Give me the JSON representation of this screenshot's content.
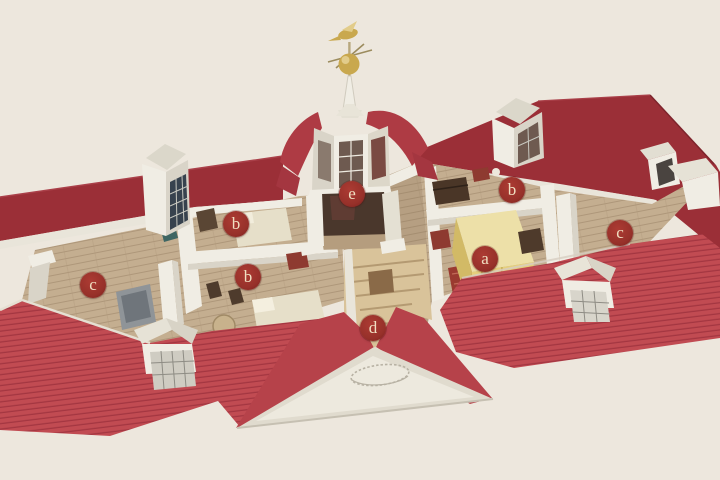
{
  "figure": {
    "type": "architectural-cutaway-illustration",
    "subject": "Bird's-eye cutaway of the third floor of a red-roofed mansion with central cupola, dormers and lettered room markers",
    "background_color": "#EDE7DD",
    "colors": {
      "roof_front": "#C14B52",
      "roof_front_line": "#A33641",
      "roof_back": "#9B2F37",
      "roof_back_edge": "#7E242C",
      "roof_smooth": "#B6424A",
      "cupola_roof": "#AE3B44",
      "cornice": "#E9E5DA",
      "wall": "#F0EDE4",
      "wall_shade": "#D9D4C8",
      "floor": "#C4AE90",
      "floor_line": "#AE977A",
      "floor_center_tint": "#8A7356",
      "interior_dark": "#4A372C",
      "window_dark": "#37424E",
      "window_red": "#6E5A50",
      "gold": "#C9A84E",
      "gold_light": "#E2CC8A",
      "stairs": "#D9C39A",
      "stair_line": "#B49A72",
      "bed_yellow": "#E5CF7C",
      "bed_cream": "#E6DFC9",
      "rug_red": "#9A3A30",
      "chest_red": "#8E3A30",
      "wood_dark": "#4A3627",
      "pediment": "#E0DBCE",
      "pediment_face": "#EDE9DE",
      "marker_bg": "#97312A",
      "marker_bg_light": "#AC3B33",
      "marker_bg_dark": "#7C1E1B",
      "marker_text": "#F0DFC2"
    },
    "markers": [
      {
        "letter": "a",
        "x": 485,
        "y": 259
      },
      {
        "letter": "b",
        "x": 236,
        "y": 224
      },
      {
        "letter": "b",
        "x": 248,
        "y": 277
      },
      {
        "letter": "b",
        "x": 512,
        "y": 190
      },
      {
        "letter": "c",
        "x": 93,
        "y": 285
      },
      {
        "letter": "c",
        "x": 620,
        "y": 233
      },
      {
        "letter": "d",
        "x": 373,
        "y": 328
      },
      {
        "letter": "e",
        "x": 352,
        "y": 194
      }
    ]
  }
}
